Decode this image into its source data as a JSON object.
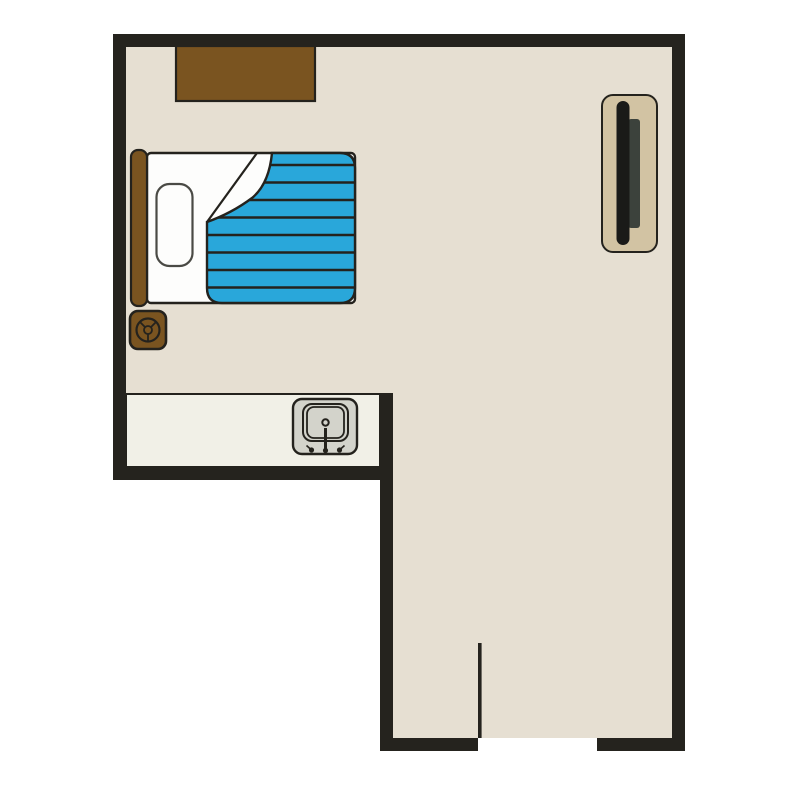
{
  "meta": {
    "title": "Studio apartment floor plan",
    "view": "top-down 2D plan",
    "canvas": {
      "width": 800,
      "height": 800
    }
  },
  "colors": {
    "background": "#ffffff",
    "wall": "#25231e",
    "floor": "#e6dfd2",
    "counter": "#f1f0e7",
    "outline": "#24221d",
    "furniture_brown": "#7a5420",
    "blanket_blue": "#29a7da",
    "sheet_white": "#fdfdfc",
    "sink_gray": "#d3d3cb",
    "tv_stand_tan": "#d2c3a3",
    "tv_screen_black": "#1a1a18",
    "tv_back_gray": "#3c423c",
    "pillow_outline": "#4a4a45"
  },
  "objects": {
    "room": {
      "label": "L-shaped studio room"
    },
    "wardrobe": {
      "label": "Wardrobe dresser against top wall"
    },
    "bed": {
      "label": "Single bed"
    },
    "headboard": {
      "label": "Bed headboard"
    },
    "pillow": {
      "label": "Pillow"
    },
    "duvet": {
      "label": "Blue striped duvet with folded corner"
    },
    "speaker": {
      "label": "Bedside speaker unit"
    },
    "counter": {
      "label": "Kitchenette counter"
    },
    "sink": {
      "label": "Sink with faucet"
    },
    "tv_unit": {
      "label": "TV stand"
    },
    "tv": {
      "label": "Flat screen TV"
    },
    "door": {
      "label": "Entry door, open"
    }
  }
}
